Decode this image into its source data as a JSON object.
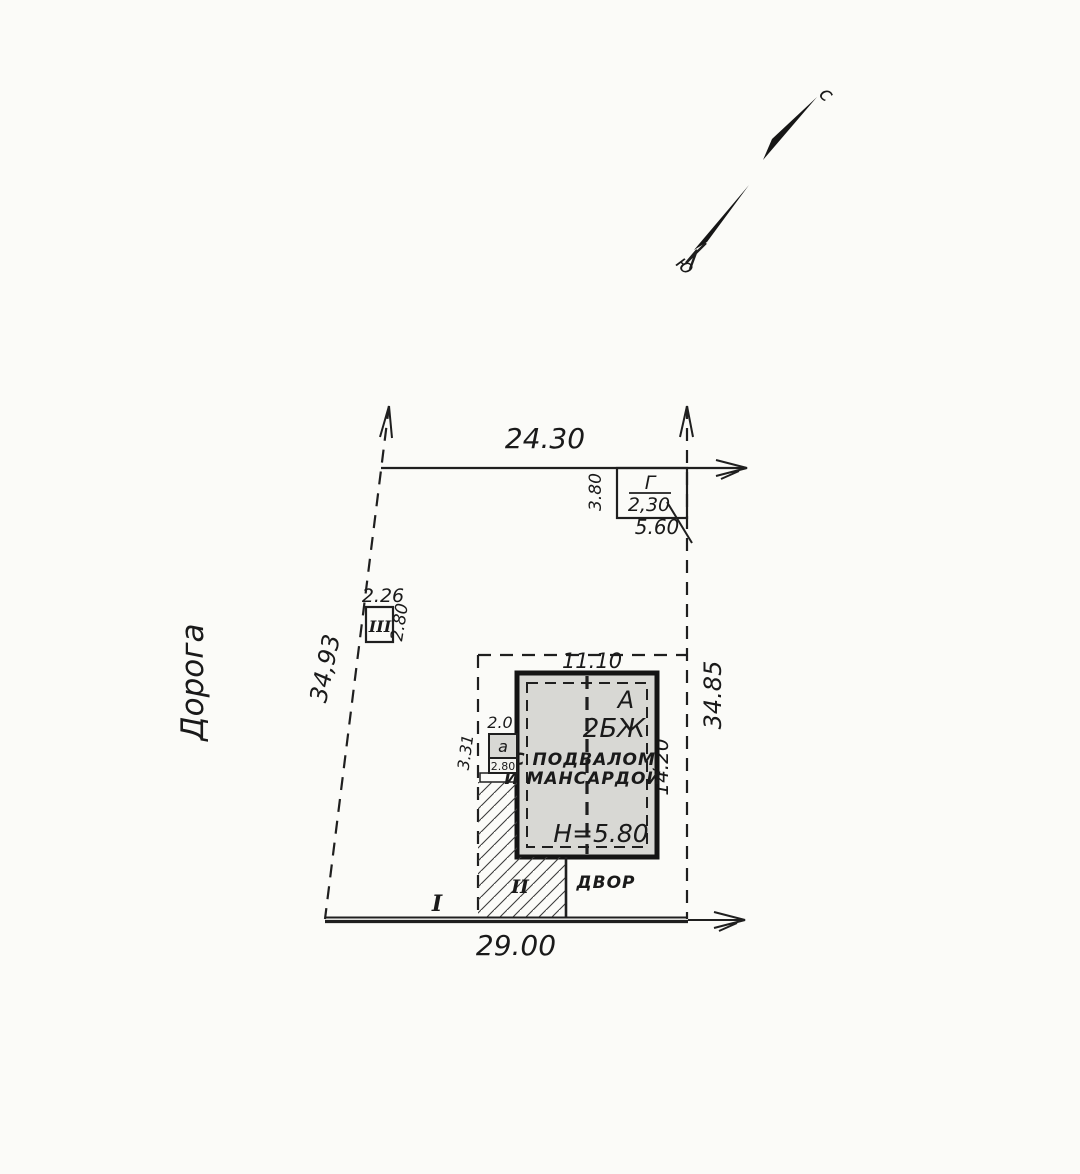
{
  "compass": {
    "north": "с",
    "south": "ю"
  },
  "road": {
    "label": "Дорога"
  },
  "dims": {
    "top": "24.30",
    "left": "34,93",
    "right": "34.85",
    "bottom": "29.00",
    "plot_width": "11.10",
    "plot_height": "14.20"
  },
  "building": {
    "litera": "А",
    "type": "2БЖ",
    "desc1": "С ПОДВАЛОМ",
    "desc2": "И МАНСАРДОЙ",
    "height": "Н=5.80"
  },
  "structures": {
    "g": {
      "label": "Г",
      "width": "2,30",
      "depth": "3.80",
      "length": "5.60"
    },
    "iii": {
      "label": "III",
      "width": "2.26",
      "depth": "2.80"
    },
    "a": {
      "label": "а",
      "width": "2.0",
      "depth": "3.31",
      "inner": "2.80"
    }
  },
  "sections": {
    "i": "I",
    "ii": "II",
    "yard": "ДВОР"
  },
  "colors": {
    "ink": "#1f1f1f",
    "paper": "#fbfbf8",
    "building_fill": "#d8d8d4"
  }
}
